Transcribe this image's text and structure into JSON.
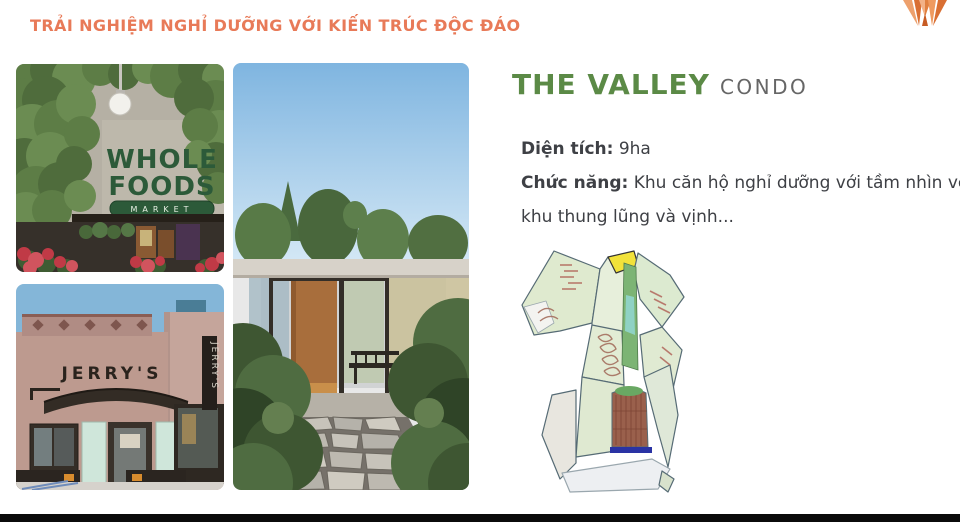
{
  "slide": {
    "title": "TRẢI NGHIỆM NGHỈ DƯỠNG VỚI KIẾN TRÚC ĐỘC ĐÁO"
  },
  "project": {
    "name": "THE VALLEY",
    "type": "CONDO"
  },
  "specs": {
    "area_label": "Diện tích:",
    "area_value": "9ha",
    "function_label": "Chức năng:",
    "function_value": "Khu căn hộ nghỉ dưỡng với tầm nhìn về khu thung lũng và vịnh..."
  },
  "photos": {
    "whole_foods": {
      "sign_word1": "WHOLE",
      "sign_word2": "FOODS",
      "banner": "MARKET"
    },
    "jerrys": {
      "sign": "JERRY'S",
      "vertical_sign": "JERRY'S"
    }
  },
  "colors": {
    "accent_orange": "#E87A58",
    "brand_green": "#5B8A46",
    "condo_gray": "#666666",
    "body_text": "#3E4045",
    "bottom_bar": "#0B0B0B",
    "map_parcel_green": "#DFEACF",
    "map_zone_yellow": "#F2E23A",
    "map_golf_green": "#7CB474",
    "map_block_brown": "#9A604C",
    "map_bar_blue": "#2A33A4"
  }
}
